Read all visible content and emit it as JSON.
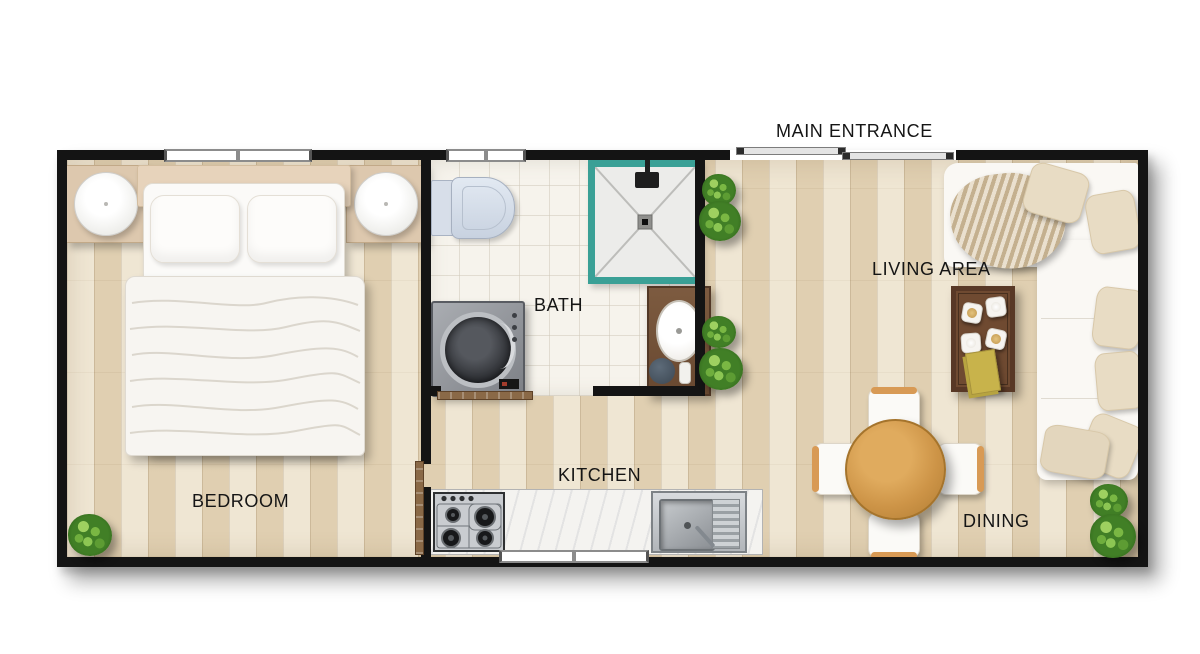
{
  "labels": {
    "main_entrance": "MAIN ENTRANCE",
    "living_area": "LIVING AREA",
    "bath": "BATH",
    "kitchen": "KITCHEN",
    "bedroom": "BEDROOM",
    "dining": "DINING"
  },
  "rooms": [
    "BEDROOM",
    "BATH",
    "KITCHEN",
    "LIVING AREA",
    "DINING"
  ],
  "furniture": {
    "bedroom": [
      "double-bed",
      "pillows",
      "duvet",
      "nightstand-left",
      "nightstand-right",
      "lamp-left",
      "lamp-right",
      "plant"
    ],
    "bath": [
      "toilet",
      "shower",
      "washing-machine",
      "vanity-sink",
      "rug",
      "sliding-door"
    ],
    "kitchen": [
      "counter",
      "gas-stove",
      "kitchen-sink"
    ],
    "living": [
      "l-shaped-sofa",
      "throw-blanket",
      "cushions",
      "coffee-table",
      "cups",
      "book",
      "plants"
    ],
    "dining": [
      "round-table",
      "chair-north",
      "chair-south",
      "chair-west",
      "chair-east",
      "plants"
    ]
  },
  "colors": {
    "background": "#ffffff",
    "wall": "#141414",
    "floor": "#e9dcc2",
    "tile": "#f6f3ec",
    "shower": "#3aa096",
    "door_wood": "#8a6947",
    "sofa": "#faf8f4",
    "cushion": "#e8dcc4",
    "table_wood": "#cf9a4e",
    "vanity_wood": "#6f4a31",
    "plant_green": "#4c8a2e",
    "label_text": "#151515"
  }
}
